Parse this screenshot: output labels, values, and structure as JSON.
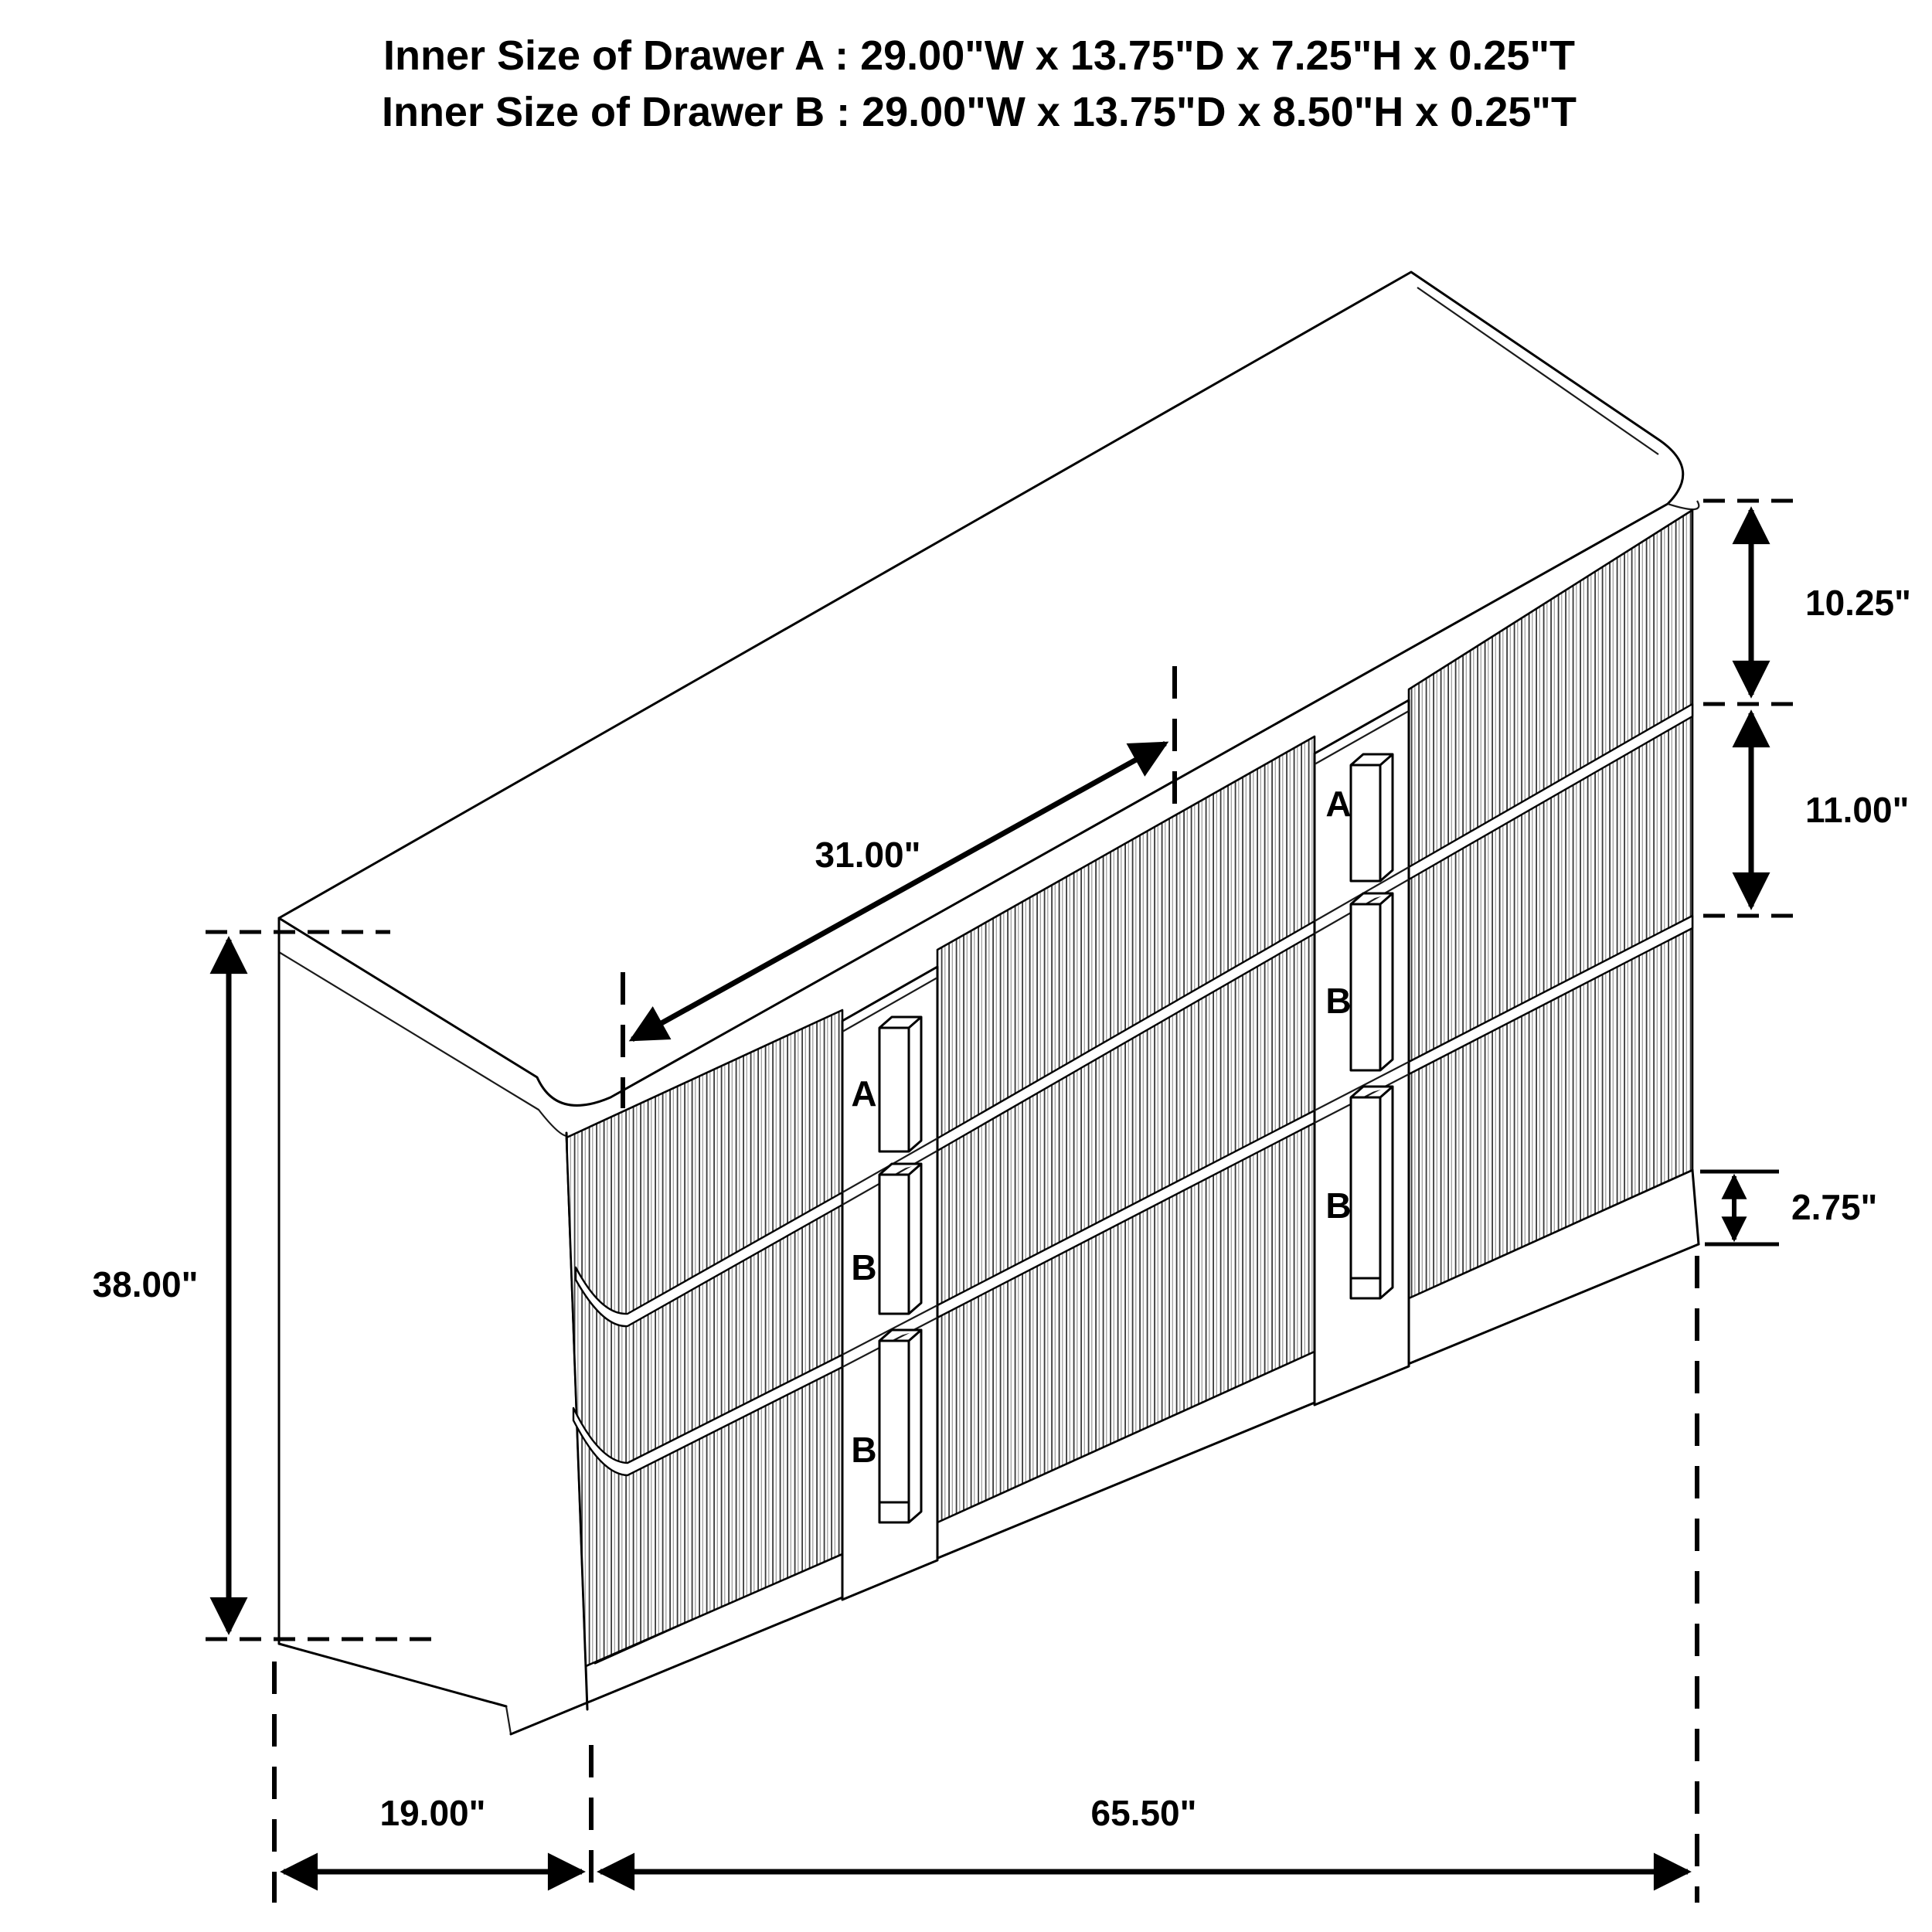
{
  "title": {
    "line1": "Inner Size of Drawer A : 29.00\"W x 13.75\"D x 7.25\"H x 0.25\"T",
    "line2": "Inner Size of Drawer B : 29.00\"W x 13.75\"D x 8.50\"H x 0.25\"T"
  },
  "dimensions": {
    "drawer_a_front_height": "10.25\"",
    "drawer_b_front_height": "11.00\"",
    "base_height": "2.75\"",
    "center_section_width": "31.00\"",
    "overall_height": "38.00\"",
    "overall_depth": "19.00\"",
    "overall_width": "65.50\""
  },
  "drawer_labels": {
    "left_bank": [
      "A",
      "B",
      "B"
    ],
    "right_bank": [
      "A",
      "B",
      "B"
    ]
  },
  "colors": {
    "line": "#000000",
    "drawer_label": "#ee1c25",
    "background": "#ffffff"
  }
}
